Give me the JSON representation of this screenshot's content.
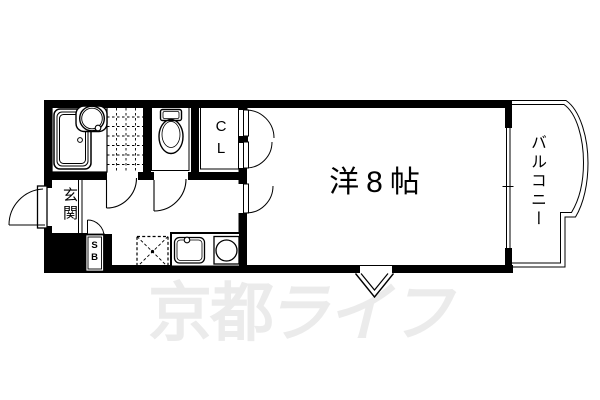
{
  "floorplan": {
    "room_label": "洋8帖",
    "entrance_label": "玄関",
    "balcony_label": "バルコニー",
    "closet": {
      "line1": "C",
      "line2": "L"
    },
    "shoebox": {
      "line1": "S",
      "line2": "B"
    },
    "watermark": {
      "text_bold": "京都",
      "text_italic": "ライフ",
      "color": "#ebebeb"
    },
    "colors": {
      "line": "#000000",
      "background": "#ffffff"
    }
  }
}
